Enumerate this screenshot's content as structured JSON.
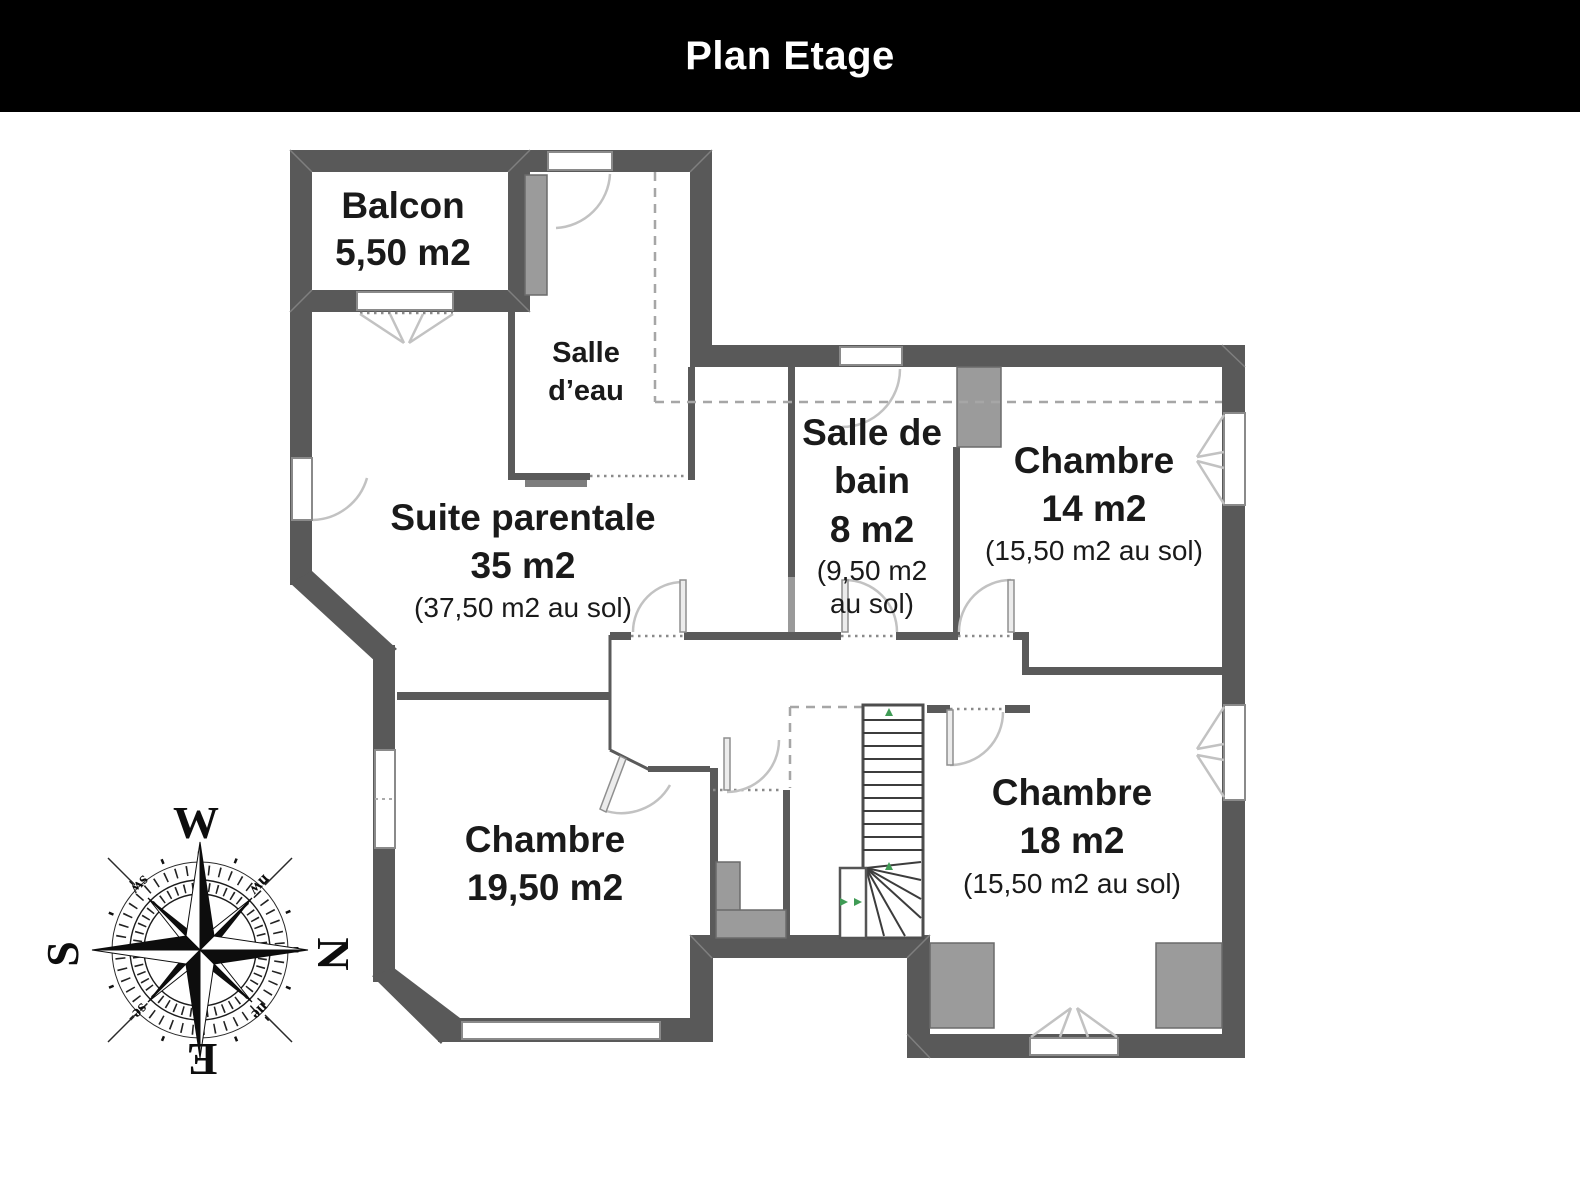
{
  "title": "Plan Etage",
  "rooms": {
    "balcon": {
      "label": "Balcon",
      "area": "5,50 m2"
    },
    "salle_deau": {
      "label_line1": "Salle",
      "label_line2": "d’eau"
    },
    "suite_parentale": {
      "label": "Suite parentale",
      "area": "35 m2",
      "floor_area": "(37,50 m2 au sol)"
    },
    "salle_de_bain": {
      "label_line1": "Salle de",
      "label_line2": "bain",
      "area": "8 m2",
      "floor_area_line1": "(9,50 m2",
      "floor_area_line2": "au sol)"
    },
    "chambre_14": {
      "label": "Chambre",
      "area": "14 m2",
      "floor_area": "(15,50 m2 au sol)"
    },
    "chambre_19": {
      "label": "Chambre",
      "area": "19,50 m2"
    },
    "chambre_18": {
      "label": "Chambre",
      "area": "18 m2",
      "floor_area": "(15,50 m2 au sol)"
    }
  },
  "compass": {
    "west": "W",
    "north": "N",
    "south": "S",
    "east": "E",
    "southwest": "sw",
    "northwest": "nw",
    "southeast": "se",
    "northeast": "ne"
  },
  "colors": {
    "wall": "#595959",
    "thin_wall": "#5a5a5a",
    "panel": "#9b9b9b",
    "door_arc": "#c2c2c2",
    "dashed_line": "#a6a6a6",
    "stair_arrow_green": "#3f9b55",
    "title_bg": "#000000",
    "title_text": "#ffffff"
  }
}
